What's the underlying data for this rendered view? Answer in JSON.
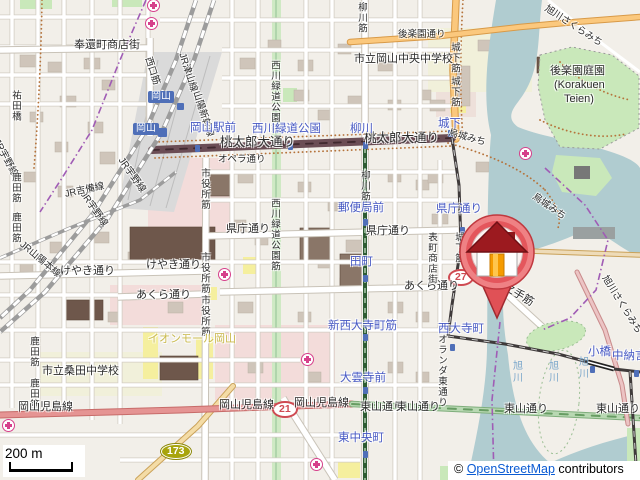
{
  "map": {
    "attribution": {
      "copyright": "© ",
      "link_text": "OpenStreetMap",
      "suffix": " contributors"
    },
    "scale_bar": {
      "label": "200 m"
    },
    "marker": {
      "name": "house-location-pin",
      "tip_x": 497,
      "tip_y": 318
    },
    "colors": {
      "land": "#f2efe9",
      "water": "#b0ccd0",
      "park": "#c9e8ba",
      "retail_area": "#f3dcda",
      "school": "#f1f0da",
      "building": "#cfc5ba",
      "building_dark": "#6e574b",
      "road_primary_red": "#e59493",
      "road_secondary_orange": "#fbc87d",
      "avenue_dark": "#6b4d55",
      "tram_green": "#2e5c33",
      "higashiyama_green": "#b8d8b2",
      "stop_text": "#4759c4",
      "hospital": "#d6408b",
      "shield_red": "#cf4a52",
      "shield_olive": "#a8a40c",
      "link": "#0b5bd3",
      "boundary_purple": "#a05cb5"
    },
    "route_shields": [
      {
        "t": "27",
        "x": 448,
        "y": 269,
        "s": "red"
      },
      {
        "t": "21",
        "x": 272,
        "y": 401,
        "s": "red"
      },
      {
        "t": "173",
        "x": 161,
        "y": 444,
        "s": "olive"
      }
    ],
    "station_boxes": [
      {
        "t": "岡山",
        "x": 148,
        "y": 91
      },
      {
        "t": "岡山",
        "x": 133,
        "y": 123
      }
    ],
    "hospital_icons": [
      [
        153,
        5
      ],
      [
        151,
        23
      ],
      [
        525,
        153
      ],
      [
        224,
        274
      ],
      [
        307,
        359
      ],
      [
        316,
        464
      ],
      [
        8,
        425
      ]
    ],
    "tram_stop_icons": [
      [
        197,
        148
      ],
      [
        290,
        146
      ],
      [
        365,
        145
      ],
      [
        450,
        133
      ],
      [
        462,
        230
      ],
      [
        365,
        222
      ],
      [
        365,
        278
      ],
      [
        365,
        337
      ],
      [
        365,
        390
      ],
      [
        365,
        454
      ],
      [
        452,
        347
      ],
      [
        592,
        369
      ],
      [
        636,
        373
      ]
    ],
    "rail_station_icons": [
      [
        180,
        106,
        7
      ],
      [
        162,
        132,
        9
      ]
    ],
    "labels": [
      {
        "t": "奉還町商店街",
        "x": 74,
        "y": 40,
        "c": "st"
      },
      {
        "t": "祐田橋",
        "x": 10,
        "y": 90,
        "c": "st v sm"
      },
      {
        "t": "西口筋",
        "x": 152,
        "y": 56,
        "c": "st sm",
        "r": 72
      },
      {
        "t": "JR津山線",
        "x": 186,
        "y": 52,
        "c": "st sm",
        "r": 72
      },
      {
        "t": "山陽新幹線",
        "x": 200,
        "y": 90,
        "c": "st sm",
        "r": 72
      },
      {
        "t": "JR宇野線",
        "x": 124,
        "y": 156,
        "c": "st sm",
        "r": 55
      },
      {
        "t": "JR宇野線",
        "x": 86,
        "y": 190,
        "c": "st sm",
        "r": 55
      },
      {
        "t": "JR吉備線",
        "x": 64,
        "y": 190,
        "c": "st sm",
        "r": -12
      },
      {
        "t": "JR山陽本線",
        "x": 24,
        "y": 240,
        "c": "st sm",
        "r": 40
      },
      {
        "t": "JR宇野線",
        "x": 0,
        "y": 138,
        "c": "st sm",
        "r": 62
      },
      {
        "t": "鹿田筋",
        "x": 10,
        "y": 172,
        "c": "st v sm"
      },
      {
        "t": "鹿田筋",
        "x": 10,
        "y": 212,
        "c": "st v sm"
      },
      {
        "t": "鹿田筋",
        "x": 28,
        "y": 336,
        "c": "st v sm"
      },
      {
        "t": "鹿田筋",
        "x": 28,
        "y": 378,
        "c": "st v sm"
      },
      {
        "t": "桃太郎大通り",
        "x": 220,
        "y": 136,
        "c": "st lg"
      },
      {
        "t": "桃太郎大通り",
        "x": 364,
        "y": 132,
        "c": "st lg"
      },
      {
        "t": "オペラ通り",
        "x": 218,
        "y": 155,
        "c": "st sm"
      },
      {
        "t": "市役所筋",
        "x": 199,
        "y": 168,
        "c": "st v sm"
      },
      {
        "t": "市役所筋",
        "x": 199,
        "y": 252,
        "c": "st v sm"
      },
      {
        "t": "市役所筋",
        "x": 199,
        "y": 295,
        "c": "st v sm"
      },
      {
        "t": "西川緑道公園筋",
        "x": 269,
        "y": 60,
        "c": "st v sm"
      },
      {
        "t": "西川緑道公園筋",
        "x": 269,
        "y": 198,
        "c": "st v sm"
      },
      {
        "t": "柳川筋",
        "x": 356,
        "y": 2,
        "c": "st v sm"
      },
      {
        "t": "柳川筋",
        "x": 359,
        "y": 170,
        "c": "st v sm"
      },
      {
        "t": "県庁通り",
        "x": 226,
        "y": 224,
        "c": "st"
      },
      {
        "t": "県庁通り",
        "x": 366,
        "y": 226,
        "c": "st"
      },
      {
        "t": "けやき通り",
        "x": 60,
        "y": 266,
        "c": "st"
      },
      {
        "t": "けやき通り",
        "x": 146,
        "y": 260,
        "c": "st"
      },
      {
        "t": "あくら通り",
        "x": 136,
        "y": 290,
        "c": "st"
      },
      {
        "t": "あくら通り",
        "x": 404,
        "y": 281,
        "c": "st"
      },
      {
        "t": "城下筋",
        "x": 449,
        "y": 42,
        "c": "st v sm"
      },
      {
        "t": "城下筋",
        "x": 449,
        "y": 76,
        "c": "st v sm"
      },
      {
        "t": "城下筋",
        "x": 453,
        "y": 232,
        "c": "st v sm"
      },
      {
        "t": "表町商店街",
        "x": 426,
        "y": 232,
        "c": "st v sm"
      },
      {
        "t": "烏城みち",
        "x": 450,
        "y": 128,
        "c": "st sm",
        "r": 16
      },
      {
        "t": "烏城みち",
        "x": 536,
        "y": 192,
        "c": "st sm",
        "r": 35
      },
      {
        "t": "後楽園通り",
        "x": 398,
        "y": 30,
        "c": "st sm"
      },
      {
        "t": "水之手筋",
        "x": 498,
        "y": 276,
        "c": "st",
        "r": 32
      },
      {
        "t": "オランダ東通り",
        "x": 436,
        "y": 334,
        "c": "st v sm"
      },
      {
        "t": "岡山児島線",
        "x": 18,
        "y": 402,
        "c": "st"
      },
      {
        "t": "岡山児島線",
        "x": 219,
        "y": 400,
        "c": "st"
      },
      {
        "t": "岡山児島線",
        "x": 294,
        "y": 398,
        "c": "st"
      },
      {
        "t": "東山通り",
        "x": 360,
        "y": 402,
        "c": "st"
      },
      {
        "t": "東山通り",
        "x": 396,
        "y": 402,
        "c": "st"
      },
      {
        "t": "東山通り",
        "x": 504,
        "y": 404,
        "c": "st"
      },
      {
        "t": "東山通り",
        "x": 596,
        "y": 404,
        "c": "st"
      },
      {
        "t": "市立岡山中央中学校",
        "x": 354,
        "y": 54,
        "c": "st"
      },
      {
        "t": "市立桑田中学校",
        "x": 42,
        "y": 366,
        "c": "st"
      },
      {
        "t": "後楽園庭園",
        "x": 550,
        "y": 66,
        "c": "st"
      },
      {
        "t": "(Korakuen",
        "x": 554,
        "y": 80,
        "c": "st"
      },
      {
        "t": "Teien)",
        "x": 564,
        "y": 94,
        "c": "st"
      },
      {
        "t": "イオンモール岡山",
        "x": 148,
        "y": 334,
        "c": "retail"
      },
      {
        "t": "旭川さくらみち",
        "x": 548,
        "y": 4,
        "c": "st sm",
        "r": 33
      },
      {
        "t": "旭川さくらみち",
        "x": 608,
        "y": 274,
        "c": "st sm",
        "r": 58
      },
      {
        "t": "旭川",
        "x": 510,
        "y": 360,
        "c": "wl"
      },
      {
        "t": "旭川",
        "x": 546,
        "y": 360,
        "c": "wl"
      },
      {
        "t": "旭川",
        "x": 576,
        "y": 356,
        "c": "wl"
      },
      {
        "t": "岡山駅前",
        "x": 190,
        "y": 122,
        "c": "stop"
      },
      {
        "t": "西川緑道公園",
        "x": 252,
        "y": 123,
        "c": "stop"
      },
      {
        "t": "柳川",
        "x": 350,
        "y": 123,
        "c": "stop"
      },
      {
        "t": "城下",
        "x": 438,
        "y": 118,
        "c": "stop"
      },
      {
        "t": "県庁通り",
        "x": 436,
        "y": 203,
        "c": "stop"
      },
      {
        "t": "郵便局前",
        "x": 338,
        "y": 202,
        "c": "stop"
      },
      {
        "t": "田町",
        "x": 350,
        "y": 256,
        "c": "stop"
      },
      {
        "t": "新西大寺町筋",
        "x": 328,
        "y": 320,
        "c": "stop"
      },
      {
        "t": "大雲寺前",
        "x": 340,
        "y": 372,
        "c": "stop"
      },
      {
        "t": "東中央町",
        "x": 338,
        "y": 432,
        "c": "stop"
      },
      {
        "t": "西大寺町",
        "x": 438,
        "y": 323,
        "c": "stop"
      },
      {
        "t": "小橋",
        "x": 588,
        "y": 346,
        "c": "stop"
      },
      {
        "t": "中納言",
        "x": 612,
        "y": 350,
        "c": "stop"
      }
    ]
  }
}
